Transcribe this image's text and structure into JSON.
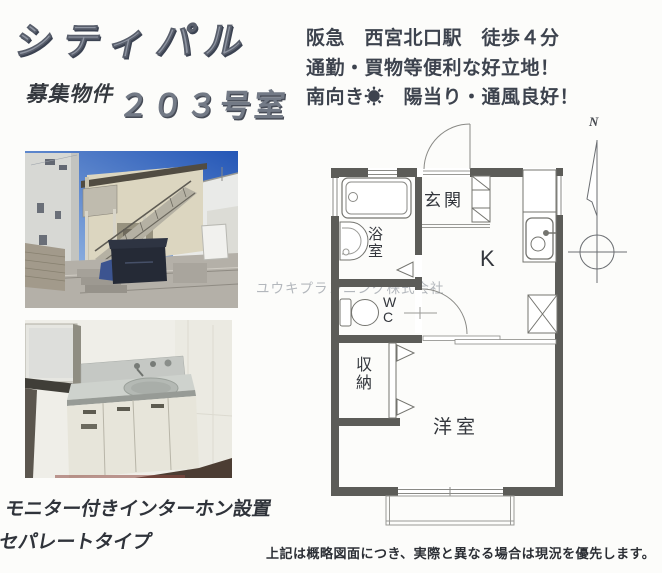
{
  "header": {
    "title": "シティパル",
    "recruit_label": "募集物件",
    "room_number": "２０３号室",
    "highlights": [
      "阪急　西宮北口駅　徒歩４分",
      "通勤・買物等便利な好立地！",
      "南向き☀　陽当り・通風良好！"
    ]
  },
  "floorplan": {
    "rooms": {
      "genkan": "玄関",
      "bath": "浴室",
      "wc": "W\nC",
      "kitchen": "K",
      "storage": "収納",
      "western_room": "洋室"
    },
    "compass_north": "N",
    "colors": {
      "wall": "#5c5c58",
      "fixture_line": "#74746f",
      "thin_line": "#8a8a86"
    }
  },
  "features": [
    "モニター付きインターホン設置",
    "セパレートタイプ"
  ],
  "watermark": "ユウキプランニング株式会社",
  "disclaimer": "上記は概略図面につき、実際と異なる場合は現況を優先します。"
}
